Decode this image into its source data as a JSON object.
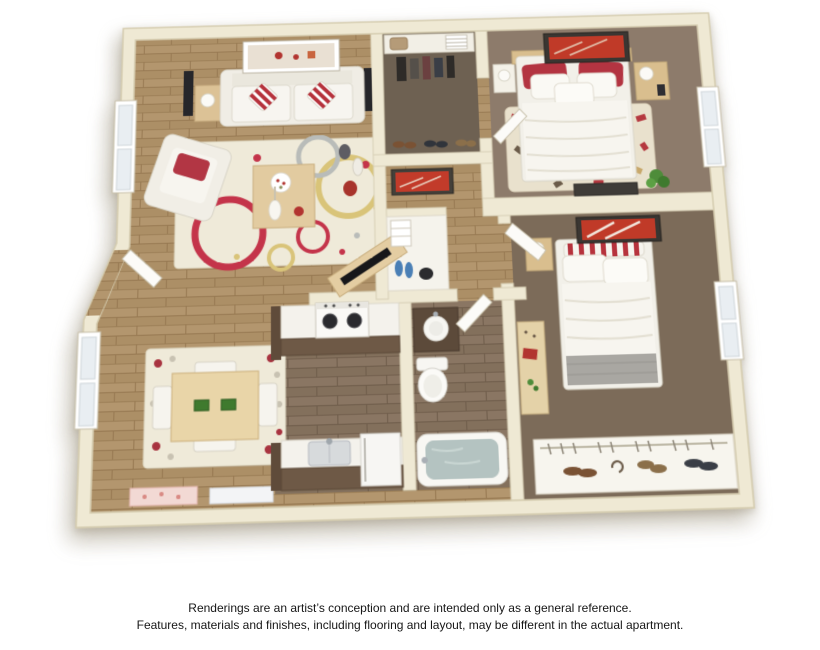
{
  "page": {
    "background": "#ffffff"
  },
  "disclaimer": {
    "line1": "Renderings are an artist’s conception and are intended only as a general reference.",
    "line2": "Features, materials and finishes, including flooring and layout, may be different in the actual apartment."
  },
  "palette": {
    "wall": "#EFE9D4",
    "wall_edge": "#D5CCAF",
    "wood_light": "#B3966E",
    "wood_dark": "#8A7663",
    "carpet_bedroom1": "#8D7B6B",
    "carpet_bedroom2": "#7C6B59",
    "carpet_closet": "#6E6152",
    "accent_red": "#C03A2B",
    "pillow_red": "#B6323C",
    "rug_cream": "#EFEAD9",
    "cabinet_brown": "#6E5946",
    "upholstery_white": "#F4F2EC",
    "tub_water": "#B4C3C1",
    "plant_green": "#4E8C3A"
  },
  "floorplan": {
    "description": "3D rendered top-down floor plan of a two-bedroom, one-bathroom apartment",
    "rooms": [
      {
        "name": "living-room",
        "furnishings": [
          "sofa with red striped pillows",
          "armchair with red pillow",
          "circle-pattern area rug",
          "coffee table",
          "two end tables with lamps",
          "two speakers",
          "wall art",
          "vases",
          "angled tv console"
        ]
      },
      {
        "name": "dining-area",
        "furnishings": [
          "square wood table",
          "four white chairs",
          "dotted rug",
          "window",
          "door mats"
        ]
      },
      {
        "name": "kitchen",
        "furnishings": [
          "stove with two burners",
          "upper counter",
          "lower counter with sink",
          "refrigerator"
        ]
      },
      {
        "name": "bathroom",
        "furnishings": [
          "vanity with round sink",
          "toilet",
          "bathtub",
          "door"
        ]
      },
      {
        "name": "walk-in-closet",
        "furnishings": [
          "top shelf with bag and towels",
          "hanging clothes",
          "shoes"
        ]
      },
      {
        "name": "linen-closet",
        "furnishings": [
          "white shelves",
          "blue slippers",
          "dark shoes"
        ]
      },
      {
        "name": "bedroom-1",
        "furnishings": [
          "double bed with red and white pillows",
          "two nightstands with lamps",
          "patterned rug",
          "plant",
          "dark dresser",
          "window",
          "red wall art",
          "door"
        ]
      },
      {
        "name": "bedroom-2",
        "furnishings": [
          "double bed with striped bolster and gray blanket",
          "nightstand with lamp",
          "desk",
          "closet shelf with shoes and hangers",
          "window",
          "red wall art",
          "door"
        ]
      },
      {
        "name": "hallway",
        "furnishings": [
          "red wall art",
          "entry door"
        ]
      }
    ]
  }
}
